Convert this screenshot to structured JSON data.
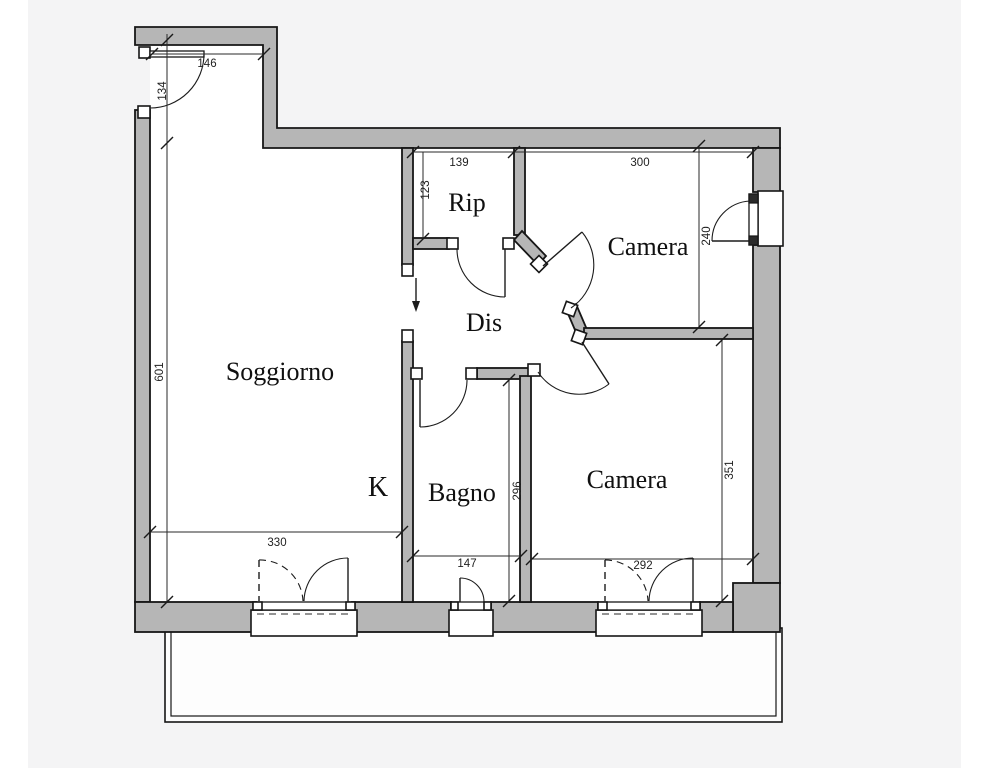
{
  "rooms": {
    "soggiorno": "Soggiorno",
    "rip": "Rip",
    "dis": "Dis",
    "kitchen": "K",
    "bagno": "Bagno",
    "camera_top": "Camera",
    "camera_bottom": "Camera"
  },
  "dims": {
    "entry_width": "146",
    "entry_depth": "134",
    "soggiorno_length": "601",
    "soggiorno_width": "330",
    "rip_width": "139",
    "rip_depth": "123",
    "camera_top_width": "300",
    "camera_top_depth": "240",
    "bagno_width": "147",
    "bagno_depth": "296",
    "camera_bottom_width": "292",
    "camera_bottom_depth": "351"
  },
  "colors": {
    "wall_fill": "#b6b6b6",
    "line": "#161616",
    "background": "#f4f4f5",
    "paper": "#ffffff"
  }
}
